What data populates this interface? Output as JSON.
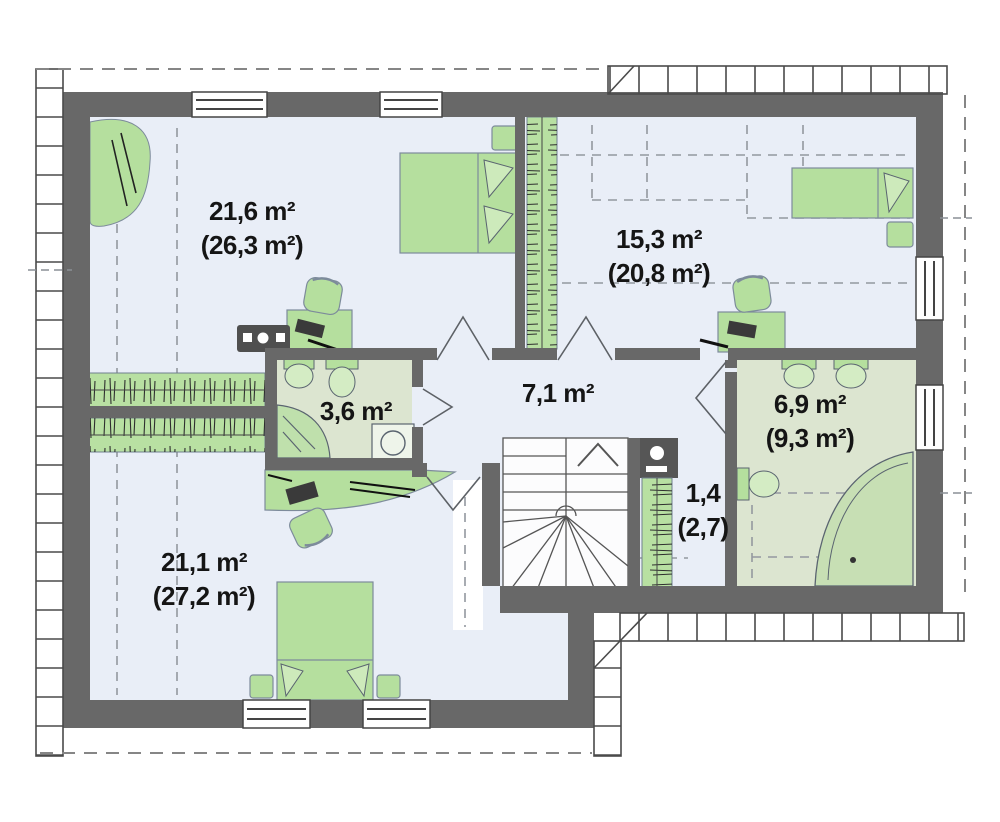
{
  "plan": {
    "title": "attic-floor-plan",
    "rooms": [
      {
        "name": "bedroom-top-left",
        "area": "21,6 m²",
        "area_gross": "(26,3 m²)"
      },
      {
        "name": "bedroom-top-right",
        "area": "15,3 m²",
        "area_gross": "(20,8 m²)"
      },
      {
        "name": "hallway",
        "area": "7,1 m²",
        "area_gross": ""
      },
      {
        "name": "bathroom-small",
        "area": "3,6 m²",
        "area_gross": ""
      },
      {
        "name": "bathroom-large",
        "area": "6,9 m²",
        "area_gross": "(9,3 m²)"
      },
      {
        "name": "storage-closet",
        "area": "1,4",
        "area_gross": "(2,7)"
      },
      {
        "name": "bedroom-bottom-left",
        "area": "21,1 m²",
        "area_gross": "(27,2 m²)"
      }
    ],
    "colors": {
      "wall": "#686868",
      "floor": "#e9eef7",
      "bath_floor": "#dce5d0",
      "furniture_green": "#b5df9e",
      "roof_outline": "#868686",
      "text": "#151515"
    }
  }
}
